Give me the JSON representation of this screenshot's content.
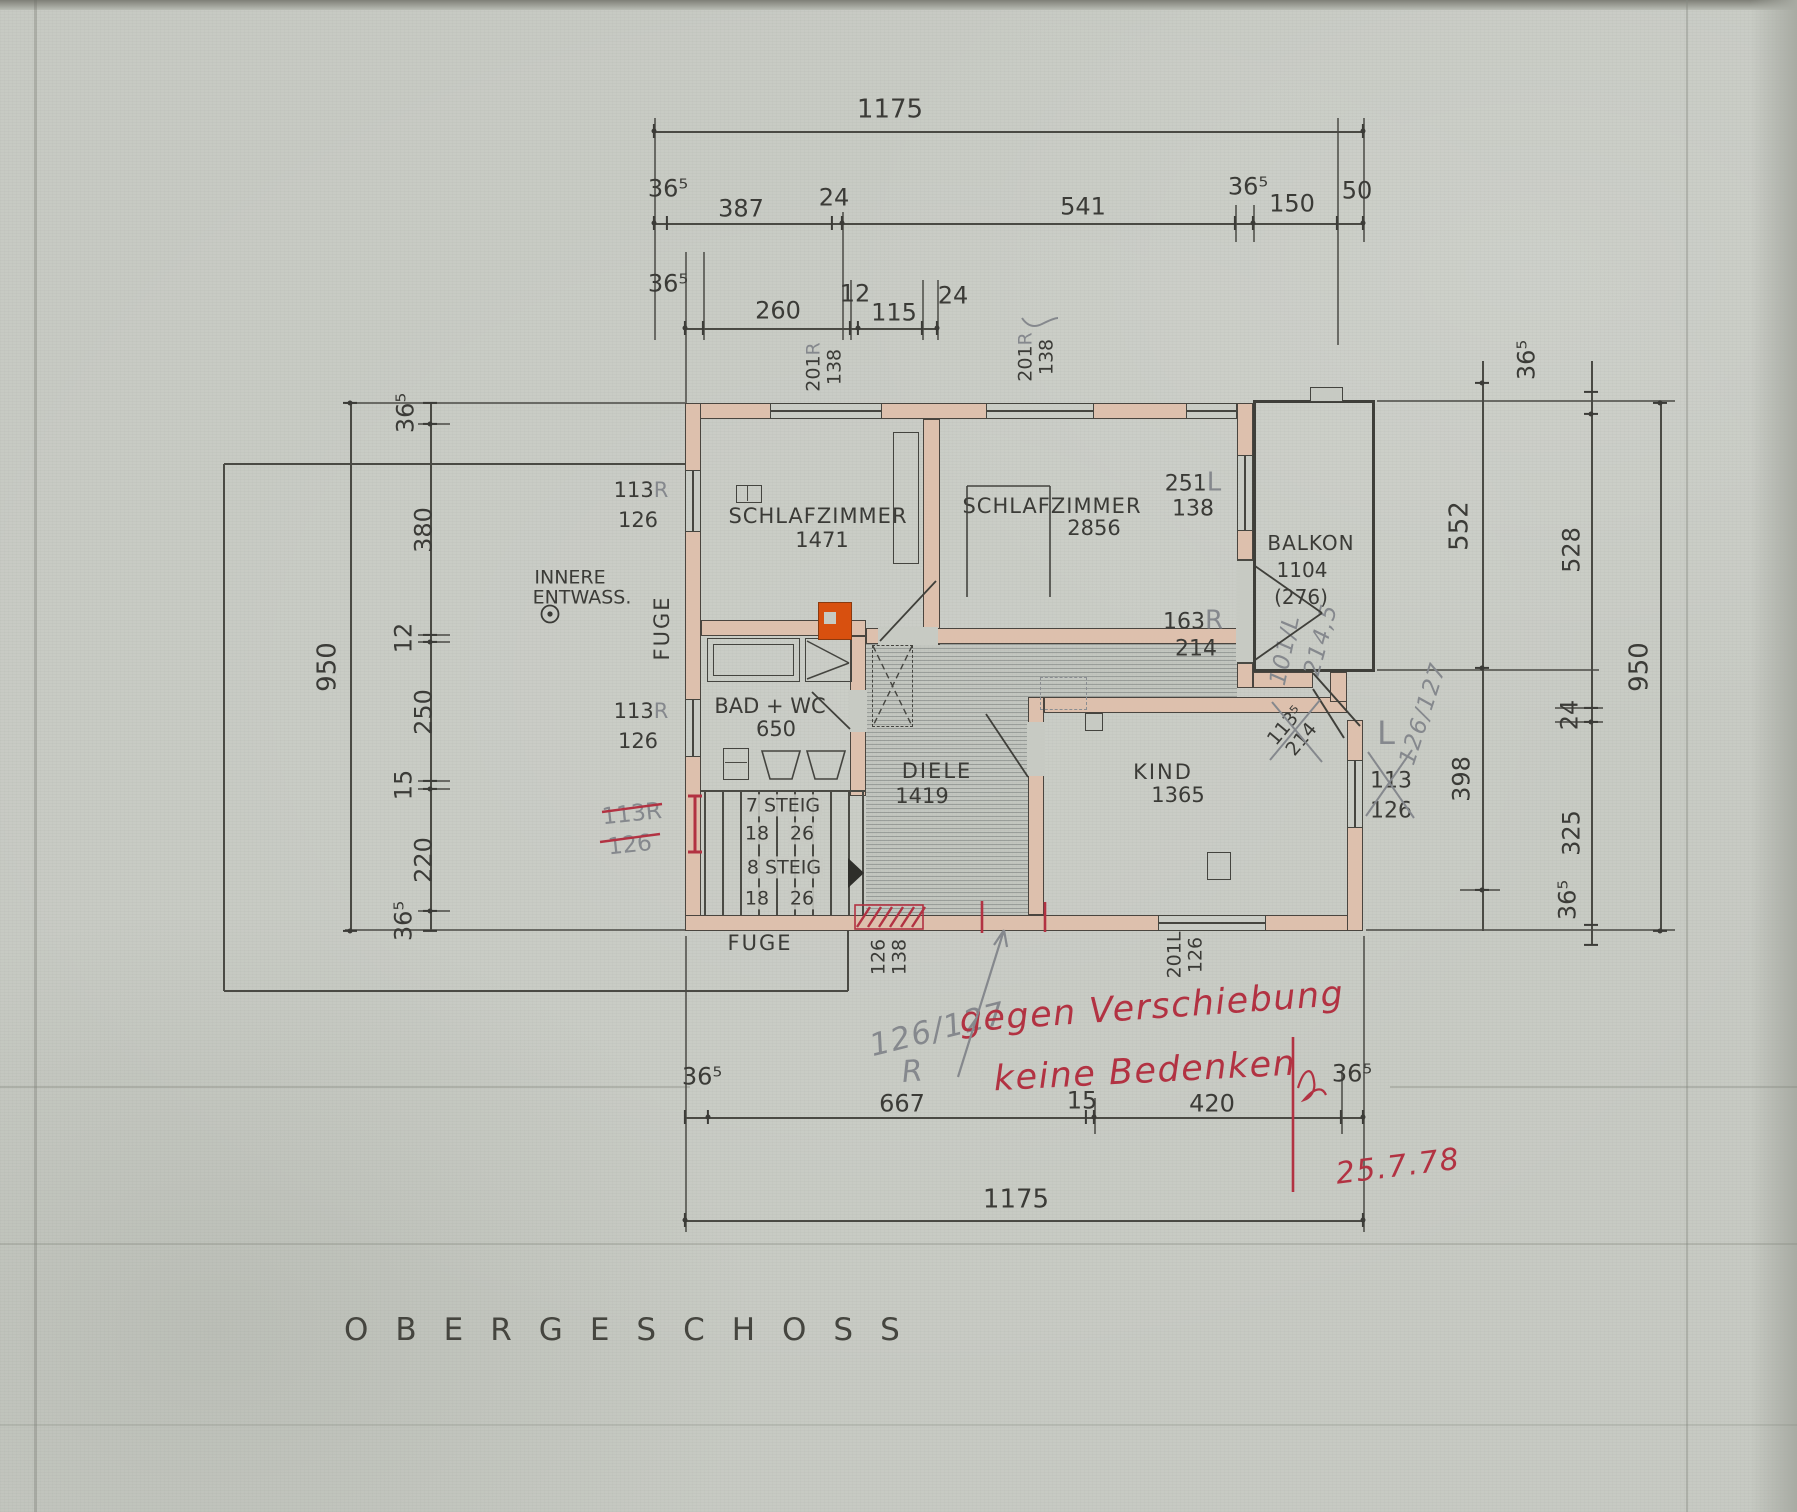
{
  "colors": {
    "paper": "#c7cac3",
    "ink": "#3b3b37",
    "wall_fill": "#ddc0ad",
    "red_ink": "#b23242",
    "pencil": "#85888d",
    "chimney_orange": "#d8500f"
  },
  "title": {
    "text": "OBERGESCHOSS"
  },
  "dims": {
    "top_overall": "1175",
    "top_row": [
      "36⁵",
      "387",
      "24",
      "541",
      "36⁵",
      "150",
      "50"
    ],
    "top_sub": [
      "36⁵",
      "260",
      "12",
      "115",
      "24"
    ],
    "left_overall": "950",
    "left_chain": [
      "36⁵",
      "380",
      "12",
      "250",
      "15",
      "220",
      "36⁵"
    ],
    "right_overall": "950",
    "right_inner": [
      "36⁵",
      "552",
      "398"
    ],
    "right_outer": [
      "528",
      "24",
      "325",
      "36⁵"
    ],
    "bottom_chain": [
      "36⁵",
      "667",
      "15",
      "420",
      "36⁵"
    ],
    "bottom_overall": "1175"
  },
  "rooms": {
    "schlafzimmer1": {
      "name": "SCHLAFZIMMER",
      "area": "1471"
    },
    "schlafzimmer2": {
      "name": "SCHLAFZIMMER",
      "area": "2856"
    },
    "balkon": {
      "name": "BALKON",
      "area": "1104",
      "area_alt": "(276)"
    },
    "bad": {
      "name": "BAD + WC",
      "area": "650"
    },
    "diele": {
      "name": "DIELE",
      "area": "1419"
    },
    "kind": {
      "name": "KIND",
      "area": "1365"
    }
  },
  "stairs": {
    "run1_label": "7 STEIG",
    "run1_rise": "18",
    "run1_tread": "26",
    "run2_label": "8 STEIG",
    "run2_rise": "18",
    "run2_tread": "26"
  },
  "openings": {
    "top_window_1": {
      "code": "201",
      "hand": "R",
      "size": "138"
    },
    "top_window_2": {
      "code": "201",
      "hand": "R",
      "size": "138"
    },
    "left_window_1": {
      "code": "113",
      "hand": "R",
      "size": "126"
    },
    "left_window_2": {
      "code": "113",
      "hand": "R",
      "size": "126"
    },
    "sz2_window": {
      "code": "251",
      "hand": "L",
      "size": "138"
    },
    "balkon_door": {
      "code": "163",
      "hand": "R",
      "size": "214"
    },
    "corner_window": {
      "code": "113⁵",
      "size": "214"
    },
    "right_window": {
      "code": "113",
      "hand": "L",
      "size": "126"
    },
    "kind_door": {
      "code": "201",
      "hand": "L",
      "size": "126"
    },
    "bottom_door": {
      "code": "126",
      "size": "138"
    },
    "crossed_left": {
      "code": "113R",
      "size": "126"
    }
  },
  "annotations": {
    "innere_line1": "INNERE",
    "innere_line2": "ENTWASS.",
    "fuge_vertical": "FUGE",
    "fuge_bottom": "FUGE"
  },
  "handwriting": {
    "pencil_101": "101/L",
    "pencil_2145": "214,5",
    "pencil_126127_right": "126/127",
    "pencil_126127_bottom": "126/127",
    "pencil_r": "R",
    "red_line1": "gegen Verschiebung",
    "red_line2": "keine Bedenken",
    "red_date": "25.7.78"
  }
}
